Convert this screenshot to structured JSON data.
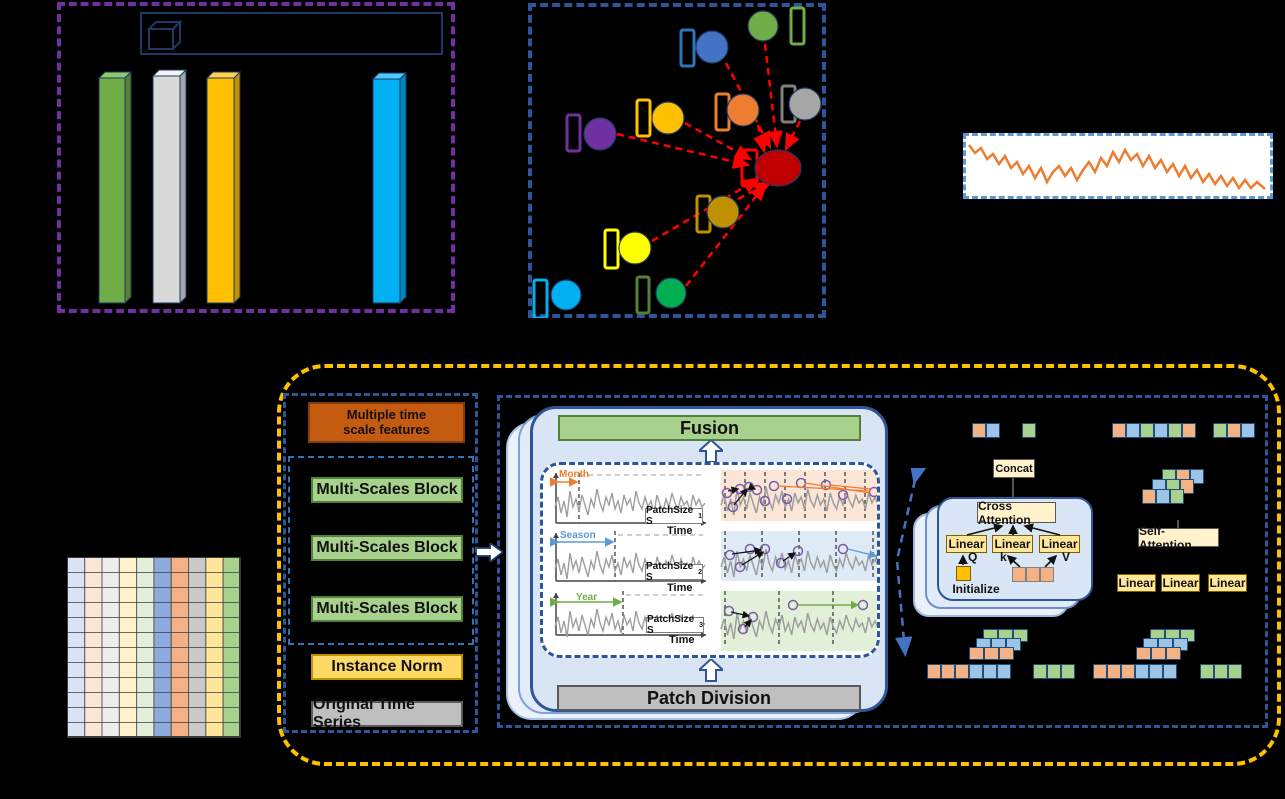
{
  "figure": {
    "background": "#000000"
  },
  "bar_chart_panel": {
    "border_color": "#7030A0",
    "legend_border_color": "#1F3864",
    "legend_icon": "cube-3d-icon",
    "bars": [
      {
        "name": "bar-green",
        "front": "#70AD47",
        "top": "#8FC76B",
        "side": "#548235"
      },
      {
        "name": "bar-silver",
        "front": "#D9D9D9",
        "top": "#F2F2F2",
        "side": "#A6A6A6"
      },
      {
        "name": "bar-gold",
        "front": "#FFC000",
        "top": "#FFD34D",
        "side": "#BF9000"
      },
      {
        "name": "bar-cyan",
        "front": "#00B0F0",
        "top": "#4DCBFF",
        "side": "#0087BF"
      }
    ]
  },
  "graph_panel": {
    "border_color": "#2E5597",
    "edge_color": "#FF0000",
    "nodes": [
      {
        "name": "node-blue",
        "color": "#4472C4",
        "rect_color": "#2E75B6"
      },
      {
        "name": "node-green-top",
        "color": "#70AD47",
        "rect_color": "#70AD47"
      },
      {
        "name": "node-gray",
        "color": "#A6A6A6",
        "rect_color": "#7F7F7F"
      },
      {
        "name": "node-orange",
        "color": "#ED7D31",
        "rect_color": "#ED7D31"
      },
      {
        "name": "node-gold",
        "color": "#FFC000",
        "rect_color": "#FFC000"
      },
      {
        "name": "node-purple",
        "color": "#7030A0",
        "rect_color": "#7030A0"
      },
      {
        "name": "node-red-center",
        "color": "#C00000",
        "rect_color": "#FF0000"
      },
      {
        "name": "node-olive",
        "color": "#BF9000",
        "rect_color": "#BF9000"
      },
      {
        "name": "node-yellow",
        "color": "#FFFF00",
        "rect_color": "#FFFF00"
      },
      {
        "name": "node-cyan",
        "color": "#00B0F0",
        "rect_color": "#00B0F0"
      },
      {
        "name": "node-green-bottom",
        "color": "#00B050",
        "rect_color": "#538135"
      }
    ]
  },
  "series_panel": {
    "border_color": "#5B9BD5",
    "line_color": "#ED7D31"
  },
  "input_grid": {
    "columns": 10,
    "rows": 12,
    "column_colors": [
      "#DAE3F3",
      "#FBE5D6",
      "#EDEDED",
      "#FFF2CC",
      "#E2F0D9",
      "#8FAADC",
      "#F4B183",
      "#C9C9C9",
      "#FFE699",
      "#A9D18E"
    ]
  },
  "pipeline": {
    "multiple_time_scale_label": "Multiple time\nscale features",
    "multi_scales_label": "Multi-Scales Block",
    "instance_norm_label": "Instance Norm",
    "original_series_label": "Original Time Series"
  },
  "multiscale_module": {
    "fusion_label": "Fusion",
    "patch_division_label": "Patch Division",
    "rows": [
      {
        "scale_label": "Month",
        "scale_color": "#ED7D31",
        "patch_prefix": "PatchSize S",
        "patch_sub": "1",
        "time_label": "Time",
        "bg": "#FBE5D6"
      },
      {
        "scale_label": "Season",
        "scale_color": "#5B9BD5",
        "patch_prefix": "PatchSize S",
        "patch_sub": "2",
        "time_label": "Time",
        "bg": "#DEEBF7"
      },
      {
        "scale_label": "Year",
        "scale_color": "#70AD47",
        "patch_prefix": "PatchSize S",
        "patch_sub": "3",
        "time_label": "Time",
        "bg": "#E2F0D9"
      }
    ]
  },
  "attention_module": {
    "concat_label": "Concat",
    "cross_attention_label": "Cross Attention",
    "linear_label": "Linear",
    "q_label": "Q",
    "k_label": "k",
    "v_label": "V",
    "initialize_label": "Initialize",
    "self_attention_label": "Self- Attention",
    "token_colors": {
      "orange": "#F4B183",
      "blue": "#9DC3E6",
      "green": "#A9D18E"
    },
    "init_square_color": "#FFC000"
  },
  "frame_colors": {
    "outer_module": "#FFC000",
    "inner_module": "#2E5597"
  }
}
